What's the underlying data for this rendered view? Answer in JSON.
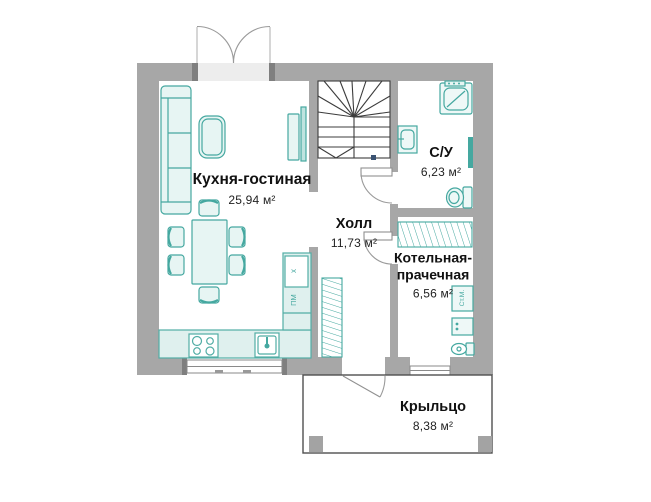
{
  "plan_title": "floor-plan-first-floor",
  "rooms": [
    {
      "id": "kitchen-living",
      "name": "Кухня-гостиная",
      "area": "25,94 м²"
    },
    {
      "id": "hall",
      "name": "Холл",
      "area": "11,73 м²"
    },
    {
      "id": "bathroom",
      "name": "С/У",
      "area": "6,23 м²"
    },
    {
      "id": "boiler-laundry",
      "name": "Котельная-прачечная",
      "area": "6,56 м²"
    },
    {
      "id": "porch",
      "name": "Крыльцо",
      "area": "8,38 м²"
    }
  ],
  "appliance_labels": {
    "fridge": "х",
    "dishwasher": "ПМ",
    "washing_machine": "Ст.М."
  },
  "colors": {
    "wall": "#a7a7a7",
    "wall_dark": "#7f7f7f",
    "furniture_stroke": "#45a8a0",
    "furniture_fill": "#e7f5f3",
    "counter_fill": "#dff0ee",
    "stair_line": "#3c3c3c",
    "text": "#111111"
  }
}
